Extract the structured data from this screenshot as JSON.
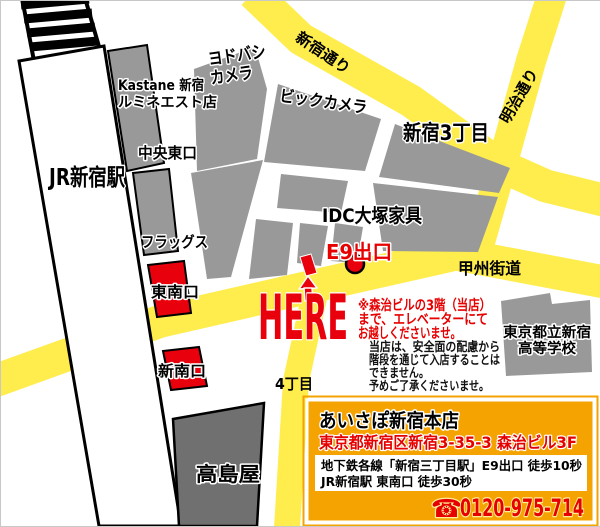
{
  "map": {
    "station": {
      "label": "JR新宿駅"
    },
    "roads": {
      "shinjuku_dori": "新宿通り",
      "meiji_dori": "明治通り",
      "koshu_kaido": "甲州街道"
    },
    "districts": {
      "sanchome": "新宿3丁目",
      "yonchome": "4丁目"
    },
    "places": {
      "kastane_line1": "Kastane 新宿",
      "kastane_line2": "ルミネエスト店",
      "yodobashi_line1": "ヨドバシ",
      "yodobashi_line2": "カメラ",
      "biccamera": "ビックカメラ",
      "idc_otsuka": "IDC大塚家具",
      "flags": "フラッグス",
      "takashimaya": "高島屋",
      "school_line1": "東京都立新宿",
      "school_line2": "高等学校"
    },
    "exits": {
      "chuo_east": "中央東口",
      "southeast": "東南口",
      "new_south": "新南口",
      "e9": "E9出口"
    },
    "here_label": "HERE",
    "red_note": {
      "line1": "※森治ビルの3階（当店）",
      "line2": "まで、エレベーターにて",
      "line3": "お越しくださいませ。"
    },
    "black_note": {
      "line1": "当店は、安全面の配慮から",
      "line2": "階段を通じて入店することは",
      "line3": "できません。",
      "line4": "予めご了承くださいませ。"
    }
  },
  "info_box": {
    "title": "あいさぽ新宿本店",
    "address": "東京都新宿区新宿3-35-3 森治ビル3F",
    "access_line1": "地下鉄各線「新宿三丁目駅」E9出口 徒歩10秒",
    "access_line2": "JR新宿駅 東南口 徒歩30秒",
    "phone_icon": "☎",
    "phone": "0120-975-714"
  },
  "colors": {
    "road_yellow": "#ffec4d",
    "block_gray": "#999999",
    "dark_gray": "#707070",
    "marker_red": "#e8000d",
    "text_red": "#e60000",
    "box_orange": "#f5a300"
  }
}
